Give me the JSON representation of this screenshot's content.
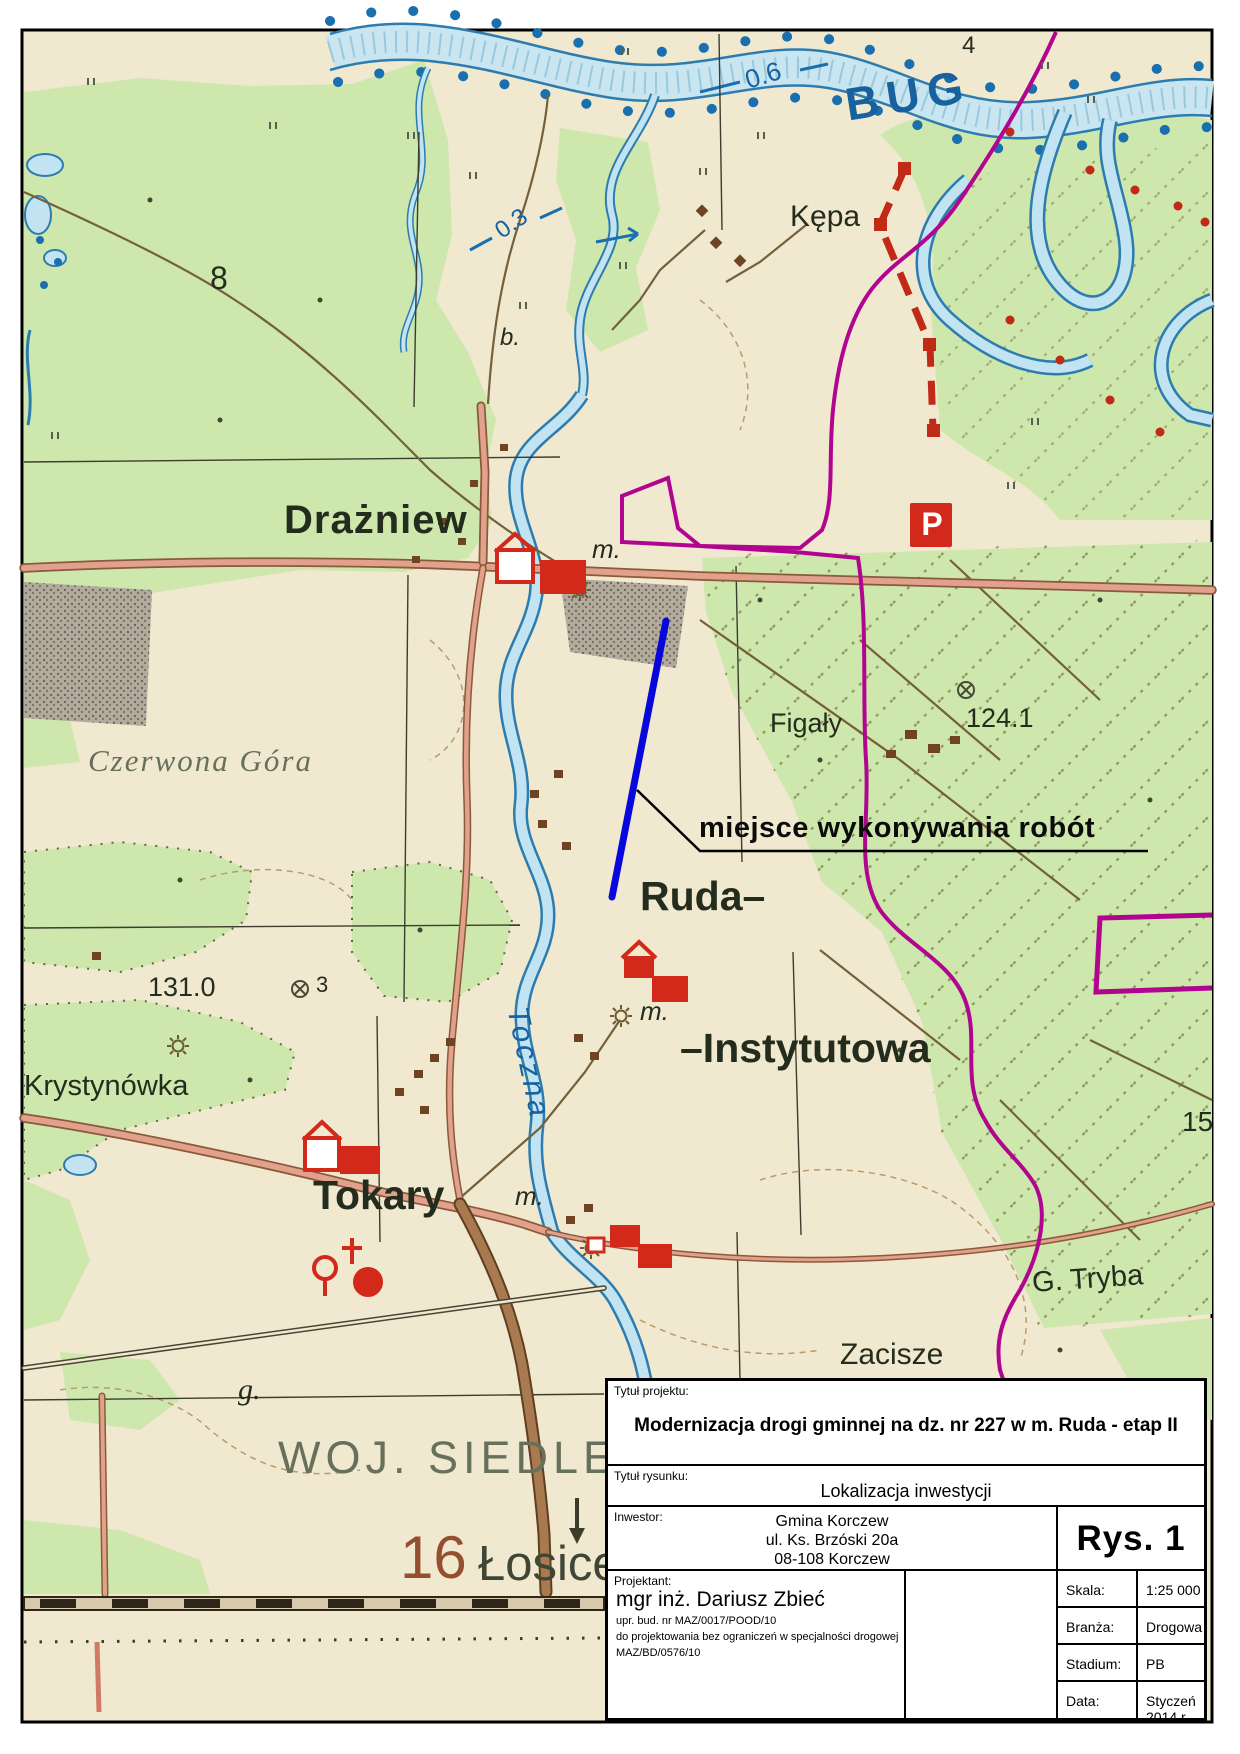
{
  "map": {
    "labels": {
      "bug": "BUG",
      "depth06": "0.6",
      "depth03": "0.3",
      "four": "4",
      "kepa": "Kępa",
      "b_dot": "b.",
      "road8": "8",
      "drazniew": "Drażniew",
      "m_dot": "m.",
      "czerwona_gora": "Czerwona Góra",
      "figaly": "Figały",
      "elev_124_1": "124.1",
      "ruda": "Ruda–",
      "instytutowa": "–Instytutowa",
      "elev_131_0": "131.0",
      "three": "3",
      "krystynowka": "Krystynówka",
      "toczna": "Toczna",
      "tokary": "Tokary",
      "g_tryba": "G. Tryba",
      "zacisze": "Zacisze",
      "n15": "15",
      "g_dot": "g.",
      "woj_siedleckie": "WOJ. SIEDLECKI",
      "n16": "16",
      "losice": "Łosice",
      "parking": "P"
    },
    "annotation": {
      "text": "miejsce wykonywania robót"
    },
    "colors": {
      "work_line_blue": "#0808dd",
      "boundary_magenta": "#b1058f",
      "water_blue": "#2d7cb0",
      "forest_green": "#cde7ad",
      "road_salmon": "#e2a18c",
      "symbol_red": "#d3291a"
    }
  },
  "title_block": {
    "project_label": "Tytuł projektu:",
    "project_title": "Modernizacja drogi gminnej na dz. nr 227 w m. Ruda - etap II",
    "drawing_label": "Tytuł rysunku:",
    "drawing_title": "Lokalizacja inwestycji",
    "investor_label": "Inwestor:",
    "investor_name": "Gmina Korczew",
    "investor_street": "ul. Ks. Brzóski 20a",
    "investor_city": "08-108 Korczew",
    "drawing_no": "Rys. 1",
    "designer_label": "Projektant:",
    "designer_name": "mgr inż. Dariusz Zbieć",
    "designer_cert1": "upr. bud. nr MAZ/0017/POOD/10",
    "designer_cert2": "do projektowania bez ograniczeń w specjalności drogowej",
    "designer_cert3": "MAZ/BD/0576/10",
    "scale_label": "Skala:",
    "scale_value": "1:25 000",
    "branch_label": "Branża:",
    "branch_value": "Drogowa",
    "stage_label": "Stadium:",
    "stage_value": "PB",
    "date_label": "Data:",
    "date_value": "Styczeń 2014 r."
  }
}
